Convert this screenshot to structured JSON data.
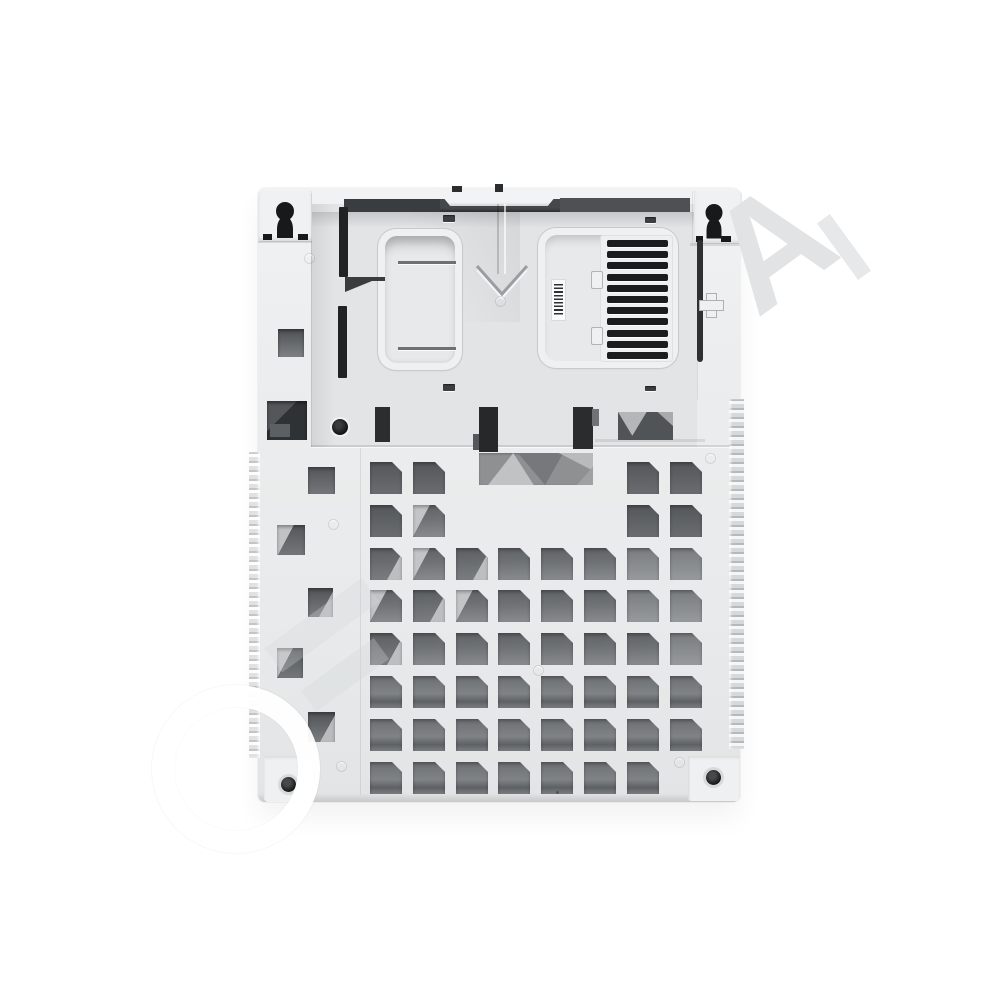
{
  "image": {
    "description": "White plastic rear enclosure panel of an industrial electronic device photographed flat on a white background, with a large diagonal photo-agency watermark",
    "background_color": "#ffffff"
  },
  "palette": {
    "body": "#ebedee",
    "panel": "#e2e4e6",
    "hole_dark": "#54575a",
    "hole_mid": "#6f7275",
    "hole_light": "#898c8f",
    "slot_black": "#1a1c1d",
    "band_dark": "#45484b",
    "outline": "#c7c9cb"
  },
  "watermark": {
    "angle_deg": -36,
    "letters": [
      {
        "ch": "O",
        "style": "ring",
        "x": 152,
        "y": 685,
        "size": 124
      },
      {
        "ch": "A",
        "style": "text",
        "x": 716,
        "y": 170,
        "size": 150
      }
    ],
    "fragments": [
      {
        "x": 836,
        "y": 212,
        "w": 16,
        "h": 70,
        "kind": "frag"
      },
      {
        "x": 262,
        "y": 610,
        "w": 120,
        "h": 30,
        "kind": "faint"
      },
      {
        "x": 300,
        "y": 662,
        "w": 90,
        "h": 26,
        "kind": "faint"
      }
    ]
  },
  "grid": {
    "rows": 8,
    "cols": 8,
    "origin_x": 370,
    "origin_y": 462,
    "cell_size": 32,
    "pitch": 42.8,
    "chamfer_px": 10,
    "missing_cells": [
      [
        1,
        3
      ],
      [
        1,
        4
      ],
      [
        1,
        5
      ],
      [
        1,
        6
      ],
      [
        2,
        3
      ],
      [
        2,
        4
      ],
      [
        2,
        5
      ],
      [
        2,
        6
      ],
      [
        8,
        8
      ]
    ],
    "watermark_cells": [
      [
        2,
        2,
        "wma"
      ],
      [
        3,
        1,
        "wmb"
      ],
      [
        3,
        2,
        "wma"
      ],
      [
        3,
        3,
        "wmb"
      ],
      [
        4,
        1,
        "wma"
      ],
      [
        4,
        2,
        "wmb"
      ],
      [
        4,
        3,
        "wma"
      ],
      [
        5,
        1,
        "wmb"
      ]
    ],
    "soft_cells": [
      [
        3,
        7
      ],
      [
        3,
        8
      ],
      [
        4,
        7
      ],
      [
        4,
        8
      ],
      [
        5,
        8
      ]
    ]
  },
  "flange_squares": [
    {
      "x": 308,
      "y": 467,
      "w": 27,
      "h": 27,
      "wm": ""
    },
    {
      "x": 277,
      "y": 525,
      "w": 28,
      "h": 30,
      "wm": "wma"
    },
    {
      "x": 308,
      "y": 588,
      "w": 25,
      "h": 29,
      "wm": "wmb"
    },
    {
      "x": 277,
      "y": 648,
      "w": 26,
      "h": 30,
      "wm": "wma"
    },
    {
      "x": 308,
      "y": 712,
      "w": 27,
      "h": 30,
      "wm": "wmb"
    }
  ],
  "vent_grille": {
    "slot_count": 11,
    "slot_left": 7,
    "slot_width": 61,
    "slot_height": 7,
    "first_top": 5,
    "pitch": 11.2
  },
  "small_slots": [
    {
      "x": 443,
      "y": 215,
      "w": 12,
      "h": 7
    },
    {
      "x": 645,
      "y": 217,
      "w": 11,
      "h": 6
    },
    {
      "x": 443,
      "y": 384,
      "w": 12,
      "h": 7
    },
    {
      "x": 645,
      "y": 386,
      "w": 11,
      "h": 5
    }
  ],
  "dimples": [
    [
      304,
      253
    ],
    [
      495,
      296
    ],
    [
      328,
      519
    ],
    [
      533,
      665
    ],
    [
      336,
      761
    ],
    [
      674,
      757
    ],
    [
      705,
      453
    ]
  ],
  "keyholes": [
    {
      "cx": 285,
      "cy": 208,
      "side": "left"
    },
    {
      "cx": 714,
      "cy": 212,
      "side": "right"
    }
  ],
  "barcode": {
    "present": true,
    "readable_text": ""
  }
}
